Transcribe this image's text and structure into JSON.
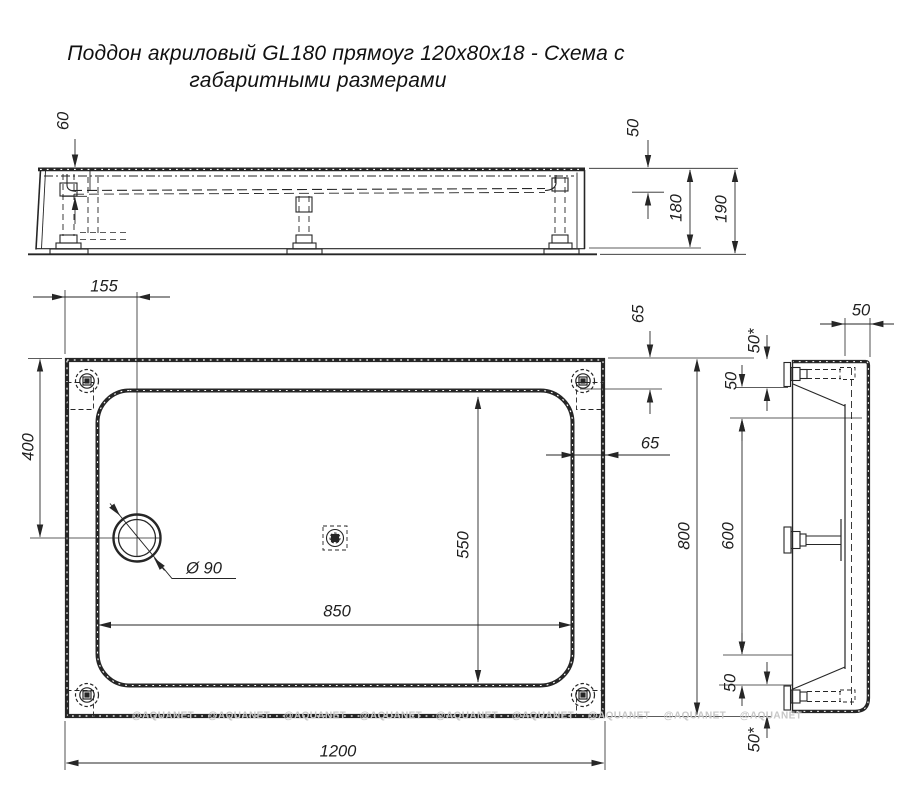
{
  "title": {
    "line1": "Поддон акриловый  GL180 прямоуг 120х80х18 - Схема с",
    "line2": "габаритными размерами"
  },
  "watermark": {
    "text": "@AQUANET"
  },
  "colors": {
    "ink": "#262626",
    "watermark": "#c7c7c7",
    "background": "#ffffff"
  },
  "dimensions": {
    "front_view": {
      "basin_depth": "60",
      "rim_height": "50",
      "body_height": "180",
      "total_height": "190"
    },
    "plan_view": {
      "drain_offset_left": "155",
      "drain_offset_top": "400",
      "drain_diameter": "Ø 90",
      "ledge_top": "65",
      "ledge_right": "65",
      "basin_length": "850",
      "basin_width": "550",
      "total_length": "1200",
      "total_width": "800"
    },
    "side_view": {
      "rim_width": "50",
      "top_edge": "50*",
      "top_foot": "50",
      "foot_spacing": "600",
      "bottom_foot": "50",
      "bottom_edge": "50*"
    }
  }
}
